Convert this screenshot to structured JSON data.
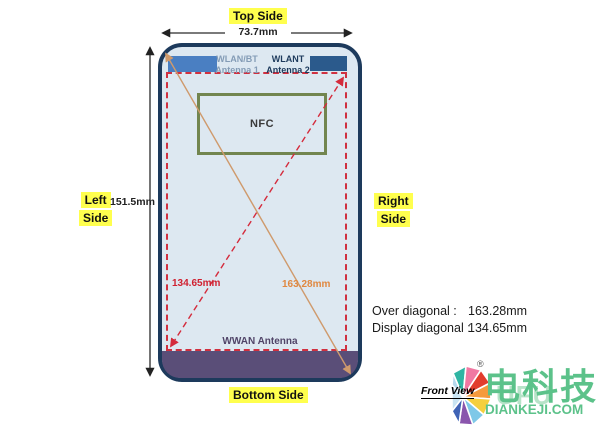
{
  "labels": {
    "top_side": "Top Side",
    "bottom_side": "Bottom Side",
    "left_side_line1": "Left",
    "left_side_line2": "Side",
    "right_side_line1": "Right",
    "right_side_line2": "Side",
    "width_dim": "73.7mm",
    "height_dim": "151.5mm",
    "front_view": "Front View"
  },
  "phone": {
    "antenna1_line1": "WLAN/BT",
    "antenna1_line2": "Antenna 1",
    "antenna2_line1": "WLANT",
    "antenna2_line2": "Antenna 2",
    "nfc": "NFC",
    "wwan": "WWAN Antenna",
    "display_diagonal_value": "134.65mm",
    "over_diagonal_value": "163.28mm"
  },
  "notes": {
    "over_label": "Over diagonal :",
    "over_value": "163.28mm",
    "display_label": "Display diagonal :",
    "display_value": "134.65mm"
  },
  "brand": {
    "registered": "®",
    "name": "电科技",
    "watermark": "UFU",
    "site": "DIANKEJI.COM"
  },
  "colors": {
    "phone_border": "#1d3a5c",
    "phone_fill": "#dde8f1",
    "antenna1_fill": "#4a7fc2",
    "antenna2_fill": "#2b5a8c",
    "display_dashed": "#d03040",
    "nfc_border": "#72854f",
    "wwan_purple": "#5a4e78",
    "over_diagonal_line": "#cf9a6c",
    "display_diagonal_line": "#d42b3c",
    "highlight_yellow": "#ffff4e",
    "brand_green": "#5cc28a"
  }
}
